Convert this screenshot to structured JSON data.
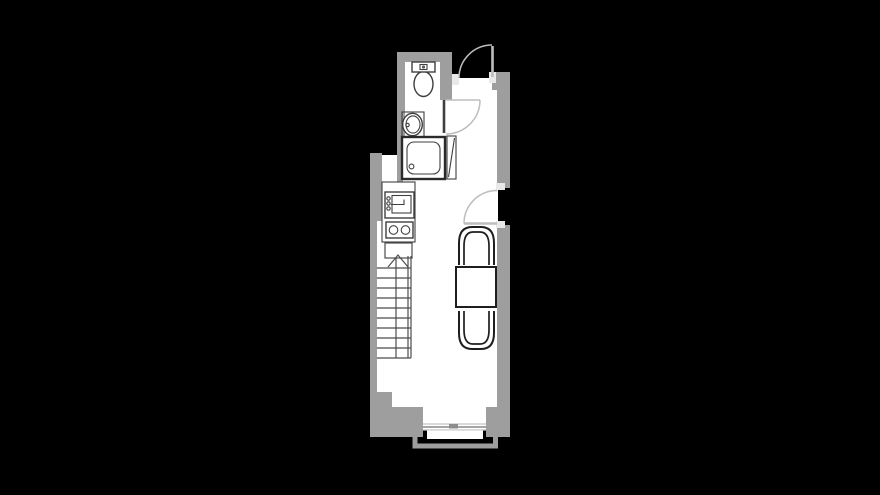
{
  "scene": {
    "title": "studio-apartment-floor-plan",
    "background": "#000000",
    "canvas": {
      "width": 880,
      "height": 495
    }
  },
  "colors": {
    "background": "#000000",
    "floor": "#ffffff",
    "wall": "#9e9e9e",
    "jamb": "#e9e9e9",
    "fixture_outline": "#3f3f3f",
    "heavy_outline": "#2a2a2a",
    "furniture_outline": "#1e1e1e",
    "door_line": "#bdbdbd",
    "stair_line": "#4c4c4c",
    "window_line": "#c4c4c4",
    "handle": "#8d8d8d"
  },
  "rooms": [
    {
      "name": "bathroom"
    },
    {
      "name": "entry-hall"
    },
    {
      "name": "kitchen"
    },
    {
      "name": "living-dining-area"
    }
  ],
  "fixtures": [
    {
      "name": "toilet",
      "room": "bathroom"
    },
    {
      "name": "washbasin",
      "room": "bathroom"
    },
    {
      "name": "shower",
      "room": "bathroom"
    },
    {
      "name": "shower-screen",
      "room": "bathroom"
    },
    {
      "name": "kitchen-counter",
      "room": "kitchen"
    },
    {
      "name": "kitchen-sink",
      "room": "kitchen"
    },
    {
      "name": "cooktop-two-burners",
      "room": "kitchen"
    },
    {
      "name": "staircase-up",
      "room": "living-dining-area"
    },
    {
      "name": "dining-table",
      "room": "living-dining-area"
    },
    {
      "name": "chair",
      "room": "living-dining-area",
      "count": 2
    },
    {
      "name": "window",
      "room": "living-dining-area"
    },
    {
      "name": "balcony-railing",
      "room": "exterior"
    }
  ],
  "doors": [
    {
      "name": "entrance-door",
      "swing": "outward",
      "location": "top"
    },
    {
      "name": "bathroom-door",
      "swing": "into-hall",
      "location": "bathroom-wall"
    },
    {
      "name": "balcony-door",
      "swing": "into-room",
      "location": "right-wall"
    }
  ]
}
